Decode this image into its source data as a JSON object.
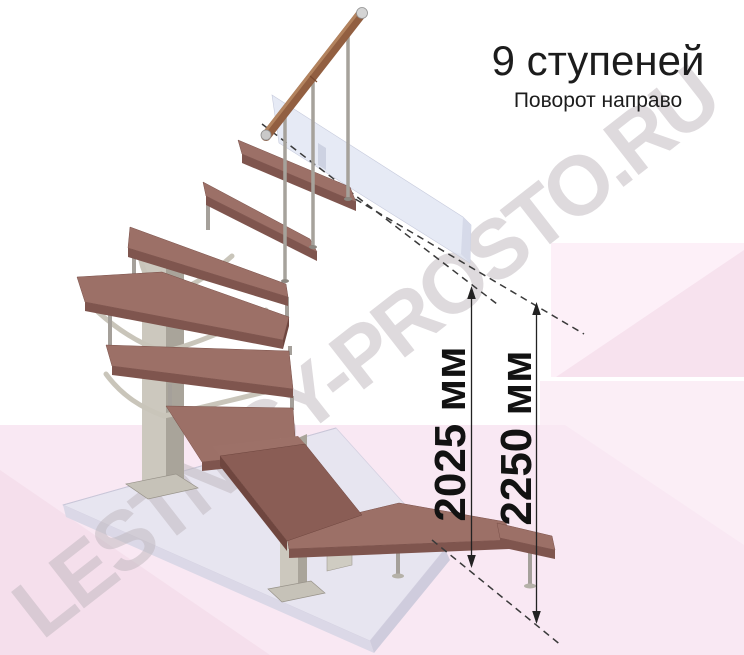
{
  "header": {
    "title": "9 ступеней",
    "subtitle": "Поворот направо"
  },
  "dimensions": {
    "stair_height": {
      "label": "2025 мм",
      "value_mm": 2025
    },
    "total_height": {
      "label": "2250 мм",
      "value_mm": 2250
    }
  },
  "watermark": {
    "text": "LESTNICY-PROSTO.RU"
  },
  "illustration": {
    "subject": "Модульная лестница на 9 ступеней с поворотом направо",
    "steps_count": 9,
    "turn_direction": "направо",
    "colors": {
      "tread_top": "#9c7067",
      "tread_front": "#7f554e",
      "tread_side": "#6f463f",
      "metal_post_light": "#ccc8be",
      "metal_post_dark": "#a9a49a",
      "baluster": "#a6a29b",
      "rail_wood": "#925f41",
      "wall_panel": "#e2e6f3",
      "floor_top": "#e7e5f0",
      "floor_side": "#d9d6e5",
      "background_pink": "#f9e8f3",
      "background_pink_dark": "#f7e2ee",
      "dimension_line": "#222222",
      "text": "#1c1c1c"
    }
  }
}
